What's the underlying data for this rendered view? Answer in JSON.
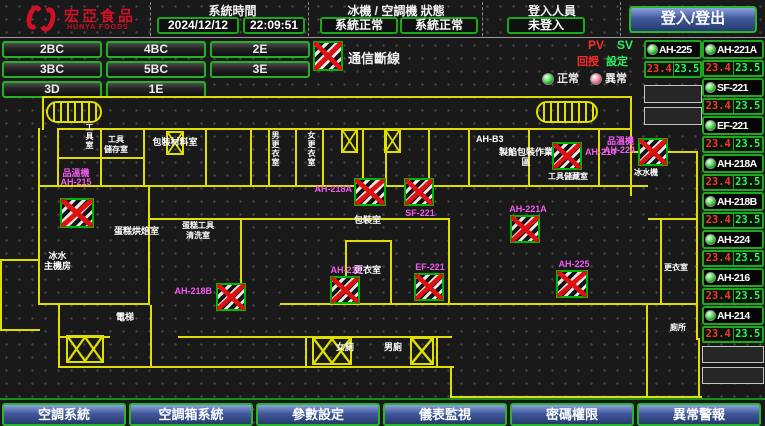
{
  "header": {
    "logo_title": "宏亞食品",
    "logo_subtitle": "HUNYA FOODS",
    "time_label": "系統時間",
    "date": "2024/12/12",
    "time": "22:09:51",
    "status_label": "冰機 / 空調機 狀態",
    "chiller_status": "系統正常",
    "ac_status": "系統正常",
    "login_label": "登入人員",
    "login_user": "未登入",
    "login_button": "登入/登出"
  },
  "floors": [
    "2BC",
    "4BC",
    "2E",
    "3BC",
    "5BC",
    "3E",
    "3D",
    "1E"
  ],
  "legend": {
    "comm_error": "通信斷線",
    "pv": "PV",
    "sv": "SV",
    "pv_name": "回授",
    "sv_name": "設定",
    "normal": "正常",
    "abnormal": "異常"
  },
  "panel": {
    "left": {
      "name": "AH-225",
      "pv": "23.4",
      "sv": "23.5"
    },
    "rows": [
      {
        "name": "AH-221A",
        "pv": "23.4",
        "sv": "23.5"
      },
      {
        "name": "SF-221",
        "pv": "23.4",
        "sv": "23.5"
      },
      {
        "name": "EF-221",
        "pv": "23.4",
        "sv": "23.5"
      },
      {
        "name": "AH-218A",
        "pv": "23.4",
        "sv": "23.5"
      },
      {
        "name": "AH-218B",
        "pv": "23.4",
        "sv": "23.5"
      },
      {
        "name": "AH-224",
        "pv": "23.4",
        "sv": "23.5"
      },
      {
        "name": "AH-216",
        "pv": "23.4",
        "sv": "23.5"
      },
      {
        "name": "AH-214",
        "pv": "23.4",
        "sv": "23.5"
      }
    ]
  },
  "floorplan": {
    "markers": [
      {
        "extra": "品溫機",
        "name": "AH-215"
      },
      {
        "name": "AH-218B"
      },
      {
        "name": "AH-218A"
      },
      {
        "name": "SF-221"
      },
      {
        "name": "AH-221A"
      },
      {
        "name": "AH-214"
      },
      {
        "extra": "品溫機",
        "name": "AH-224"
      },
      {
        "name": "AH-216"
      },
      {
        "name": "EF-221"
      },
      {
        "name": "AH-225"
      }
    ],
    "rooms": [
      {
        "label": "工具室"
      },
      {
        "label": "工具\n儲存室"
      },
      {
        "label": "包裝材料室"
      },
      {
        "label": "男更衣室"
      },
      {
        "label": "女更衣室"
      },
      {
        "label": "AH-B3"
      },
      {
        "label": "製餡包裝作業區"
      },
      {
        "label": "蛋糕烘焙室"
      },
      {
        "label": "蛋糕工具\n清洗室"
      },
      {
        "label": "冰水\n主機房"
      },
      {
        "label": "包裝室"
      },
      {
        "label": "更衣室"
      },
      {
        "label": "電梯"
      },
      {
        "label": "女廁"
      },
      {
        "label": "男廁"
      },
      {
        "label": "更衣室"
      },
      {
        "label": "廁所"
      },
      {
        "label": "冰水機"
      },
      {
        "label": "工具儲藏室"
      }
    ]
  },
  "footer": [
    "空調系統",
    "空調箱系統",
    "參數設定",
    "儀表監視",
    "密碼權限",
    "異常警報"
  ]
}
